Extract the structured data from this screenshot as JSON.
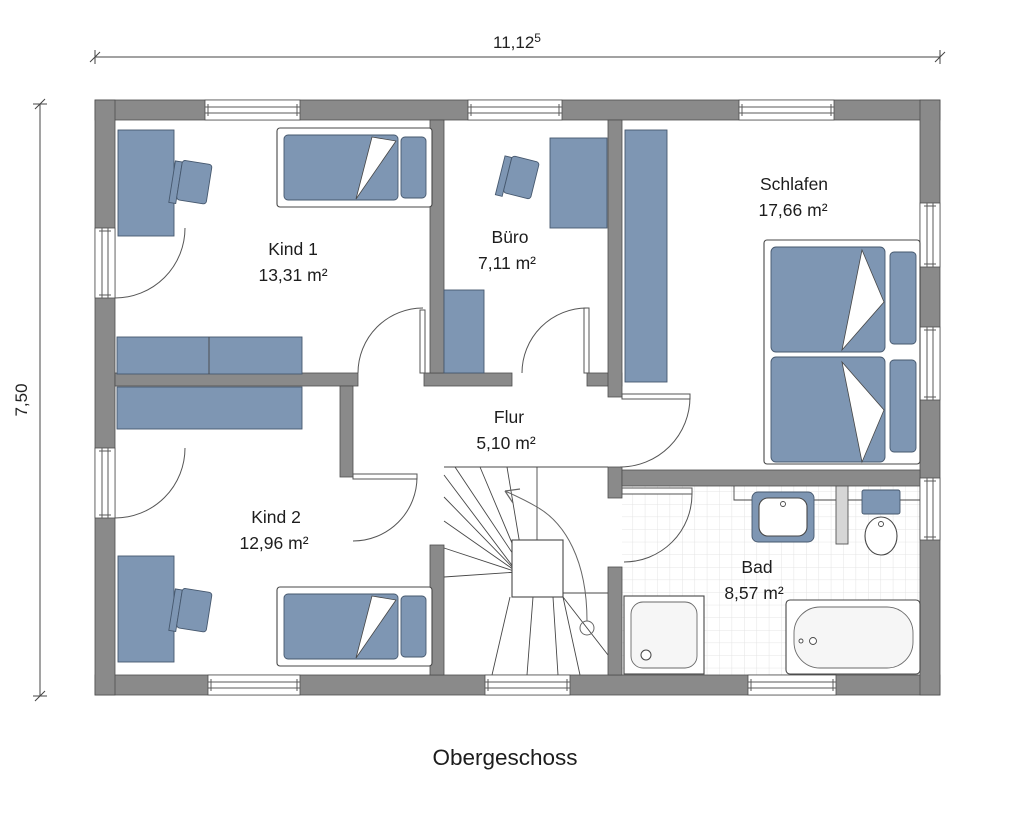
{
  "title": "Obergeschoss",
  "dimensions": {
    "width_main": "11,12",
    "width_sup": "5",
    "height": "7,50"
  },
  "rooms": [
    {
      "id": "kind1",
      "name": "Kind 1",
      "area": "13,31 m²"
    },
    {
      "id": "buero",
      "name": "Büro",
      "area": "7,11 m²"
    },
    {
      "id": "schlafen",
      "name": "Schlafen",
      "area": "17,66 m²"
    },
    {
      "id": "kind2",
      "name": "Kind 2",
      "area": "12,96 m²"
    },
    {
      "id": "flur",
      "name": "Flur",
      "area": "5,10 m²"
    },
    {
      "id": "bad",
      "name": "Bad",
      "area": "8,57 m²"
    }
  ],
  "colors": {
    "wall": "#8a8a8a",
    "wall-stroke": "#4d4d4d",
    "furn": "#7e96b3",
    "furn-stroke": "#46586e",
    "tile": "#e4e4e4",
    "line": "#3c3c3c",
    "text": "#1d1d1d"
  }
}
